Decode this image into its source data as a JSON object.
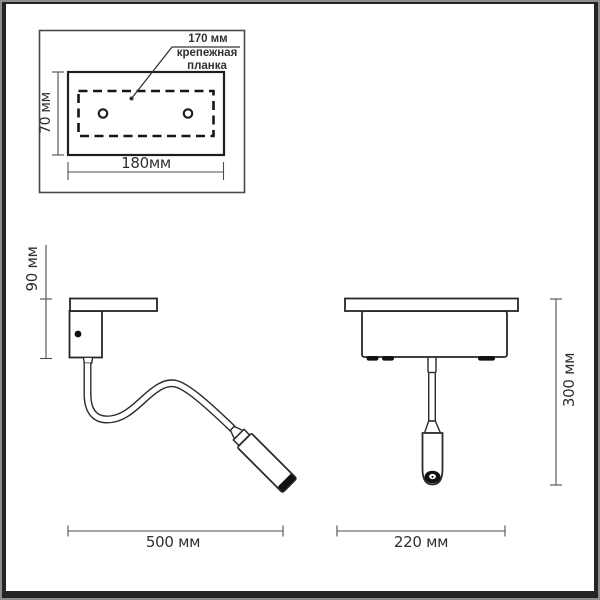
{
  "title": "wall-lamp-technical-drawing",
  "colors": {
    "background": "#ffffff",
    "line": "#2b2b2b",
    "dimension_line": "#4d4d4d",
    "text": "#2f2f2f",
    "frame": "#242424",
    "fill_black": "#111111"
  },
  "mounting_inset": {
    "hole_spacing_label": "170 мм",
    "plate_name_line1": "крепежная",
    "plate_name_line2": "планка",
    "plate_height_label": "70 мм",
    "plate_width_label": "180мм"
  },
  "side_view": {
    "base_height_label": "90 мм",
    "reach_label": "500 мм"
  },
  "front_view": {
    "drop_height_label": "300 мм",
    "base_width_label": "220 мм"
  }
}
